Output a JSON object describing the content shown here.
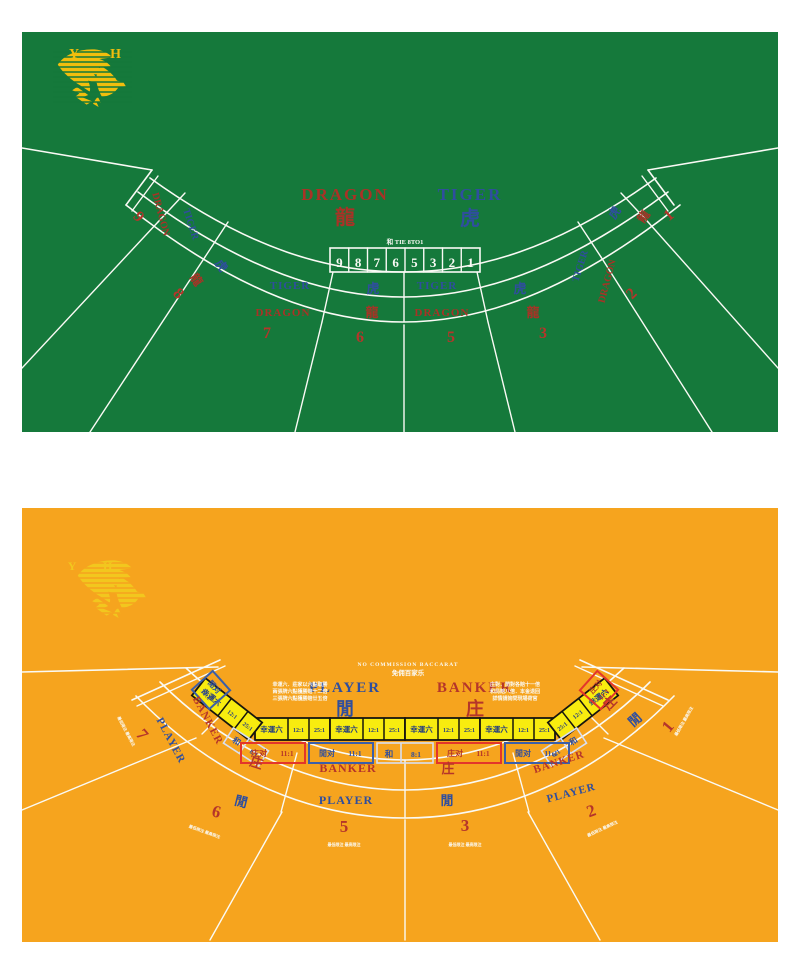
{
  "dt": {
    "felt": "#15793B",
    "logo_letters": "Y H",
    "title": {
      "dragon_en": "DRAGON",
      "dragon_zh": "龍",
      "tiger_en": "TIGER",
      "tiger_zh": "虎"
    },
    "tie": {
      "label": "和 TIE 8TO1",
      "boxes": [
        "9",
        "8",
        "7",
        "6",
        "5",
        "3",
        "2",
        "1"
      ]
    },
    "seats": [
      {
        "num": "9",
        "outer": "DRAGON",
        "inner": "TIGER"
      },
      {
        "num": "8",
        "outer": "龍",
        "inner": "虎"
      },
      {
        "num": "7",
        "outer": "DRAGON",
        "inner": "TIGER"
      },
      {
        "num": "6",
        "outer": "龍",
        "inner": "虎"
      },
      {
        "num": "5",
        "outer": "DRAGON",
        "inner": "TIGER"
      },
      {
        "num": "3",
        "outer": "龍",
        "inner": "虎"
      },
      {
        "num": "2",
        "outer": "DRAGON",
        "inner": "TIGER"
      },
      {
        "num": "1",
        "outer": "龍",
        "inner": "虎"
      }
    ]
  },
  "bac": {
    "felt": "#F6A41E",
    "logo_letters": "Y H",
    "header": {
      "en": "NO COMMISSION BACCARAT",
      "zh": "免佣百家乐"
    },
    "title": {
      "player_en": "PLAYER",
      "player_zh": "閒",
      "banker_en": "BANKER",
      "banker_zh": "庄"
    },
    "rules_left": [
      "幸運六．莊家以六點取勝",
      "兩張牌六點獲勝賠十二倍",
      "三張牌六點獲勝賠廿五倍"
    ],
    "rules_right": [
      "庄對．閒對各賠十一倍",
      "和局賠八倍．本金退回",
      "詳情請詢問現場荷官"
    ],
    "lucky6": {
      "label": "幸運六",
      "odds_a": "12:1",
      "odds_b": "25:1"
    },
    "pairs": {
      "banker_label": "庄对",
      "banker_odds": "11:1",
      "player_label": "閒对",
      "player_odds": "11:1",
      "tie_label": "和",
      "tie_odds": "8:1"
    },
    "seats": [
      {
        "num": "7",
        "banker": "BANKER",
        "player": "PLAYER"
      },
      {
        "num": "6",
        "banker": "庄",
        "player": "閒"
      },
      {
        "num": "5",
        "banker": "BANKER",
        "player": "PLAYER"
      },
      {
        "num": "3",
        "banker": "庄",
        "player": "閒"
      },
      {
        "num": "2",
        "banker": "BANKER",
        "player": "PLAYER"
      },
      {
        "num": "1",
        "banker": "庄",
        "player": "閒"
      }
    ],
    "seat_note": "最低限注 最高限注"
  },
  "colors": {
    "red": "#B5352A",
    "blue": "#2F4E9E",
    "gold": "#F1BE0D",
    "yellow": "#F8EC0F",
    "line_white": "#FAFAF5"
  }
}
